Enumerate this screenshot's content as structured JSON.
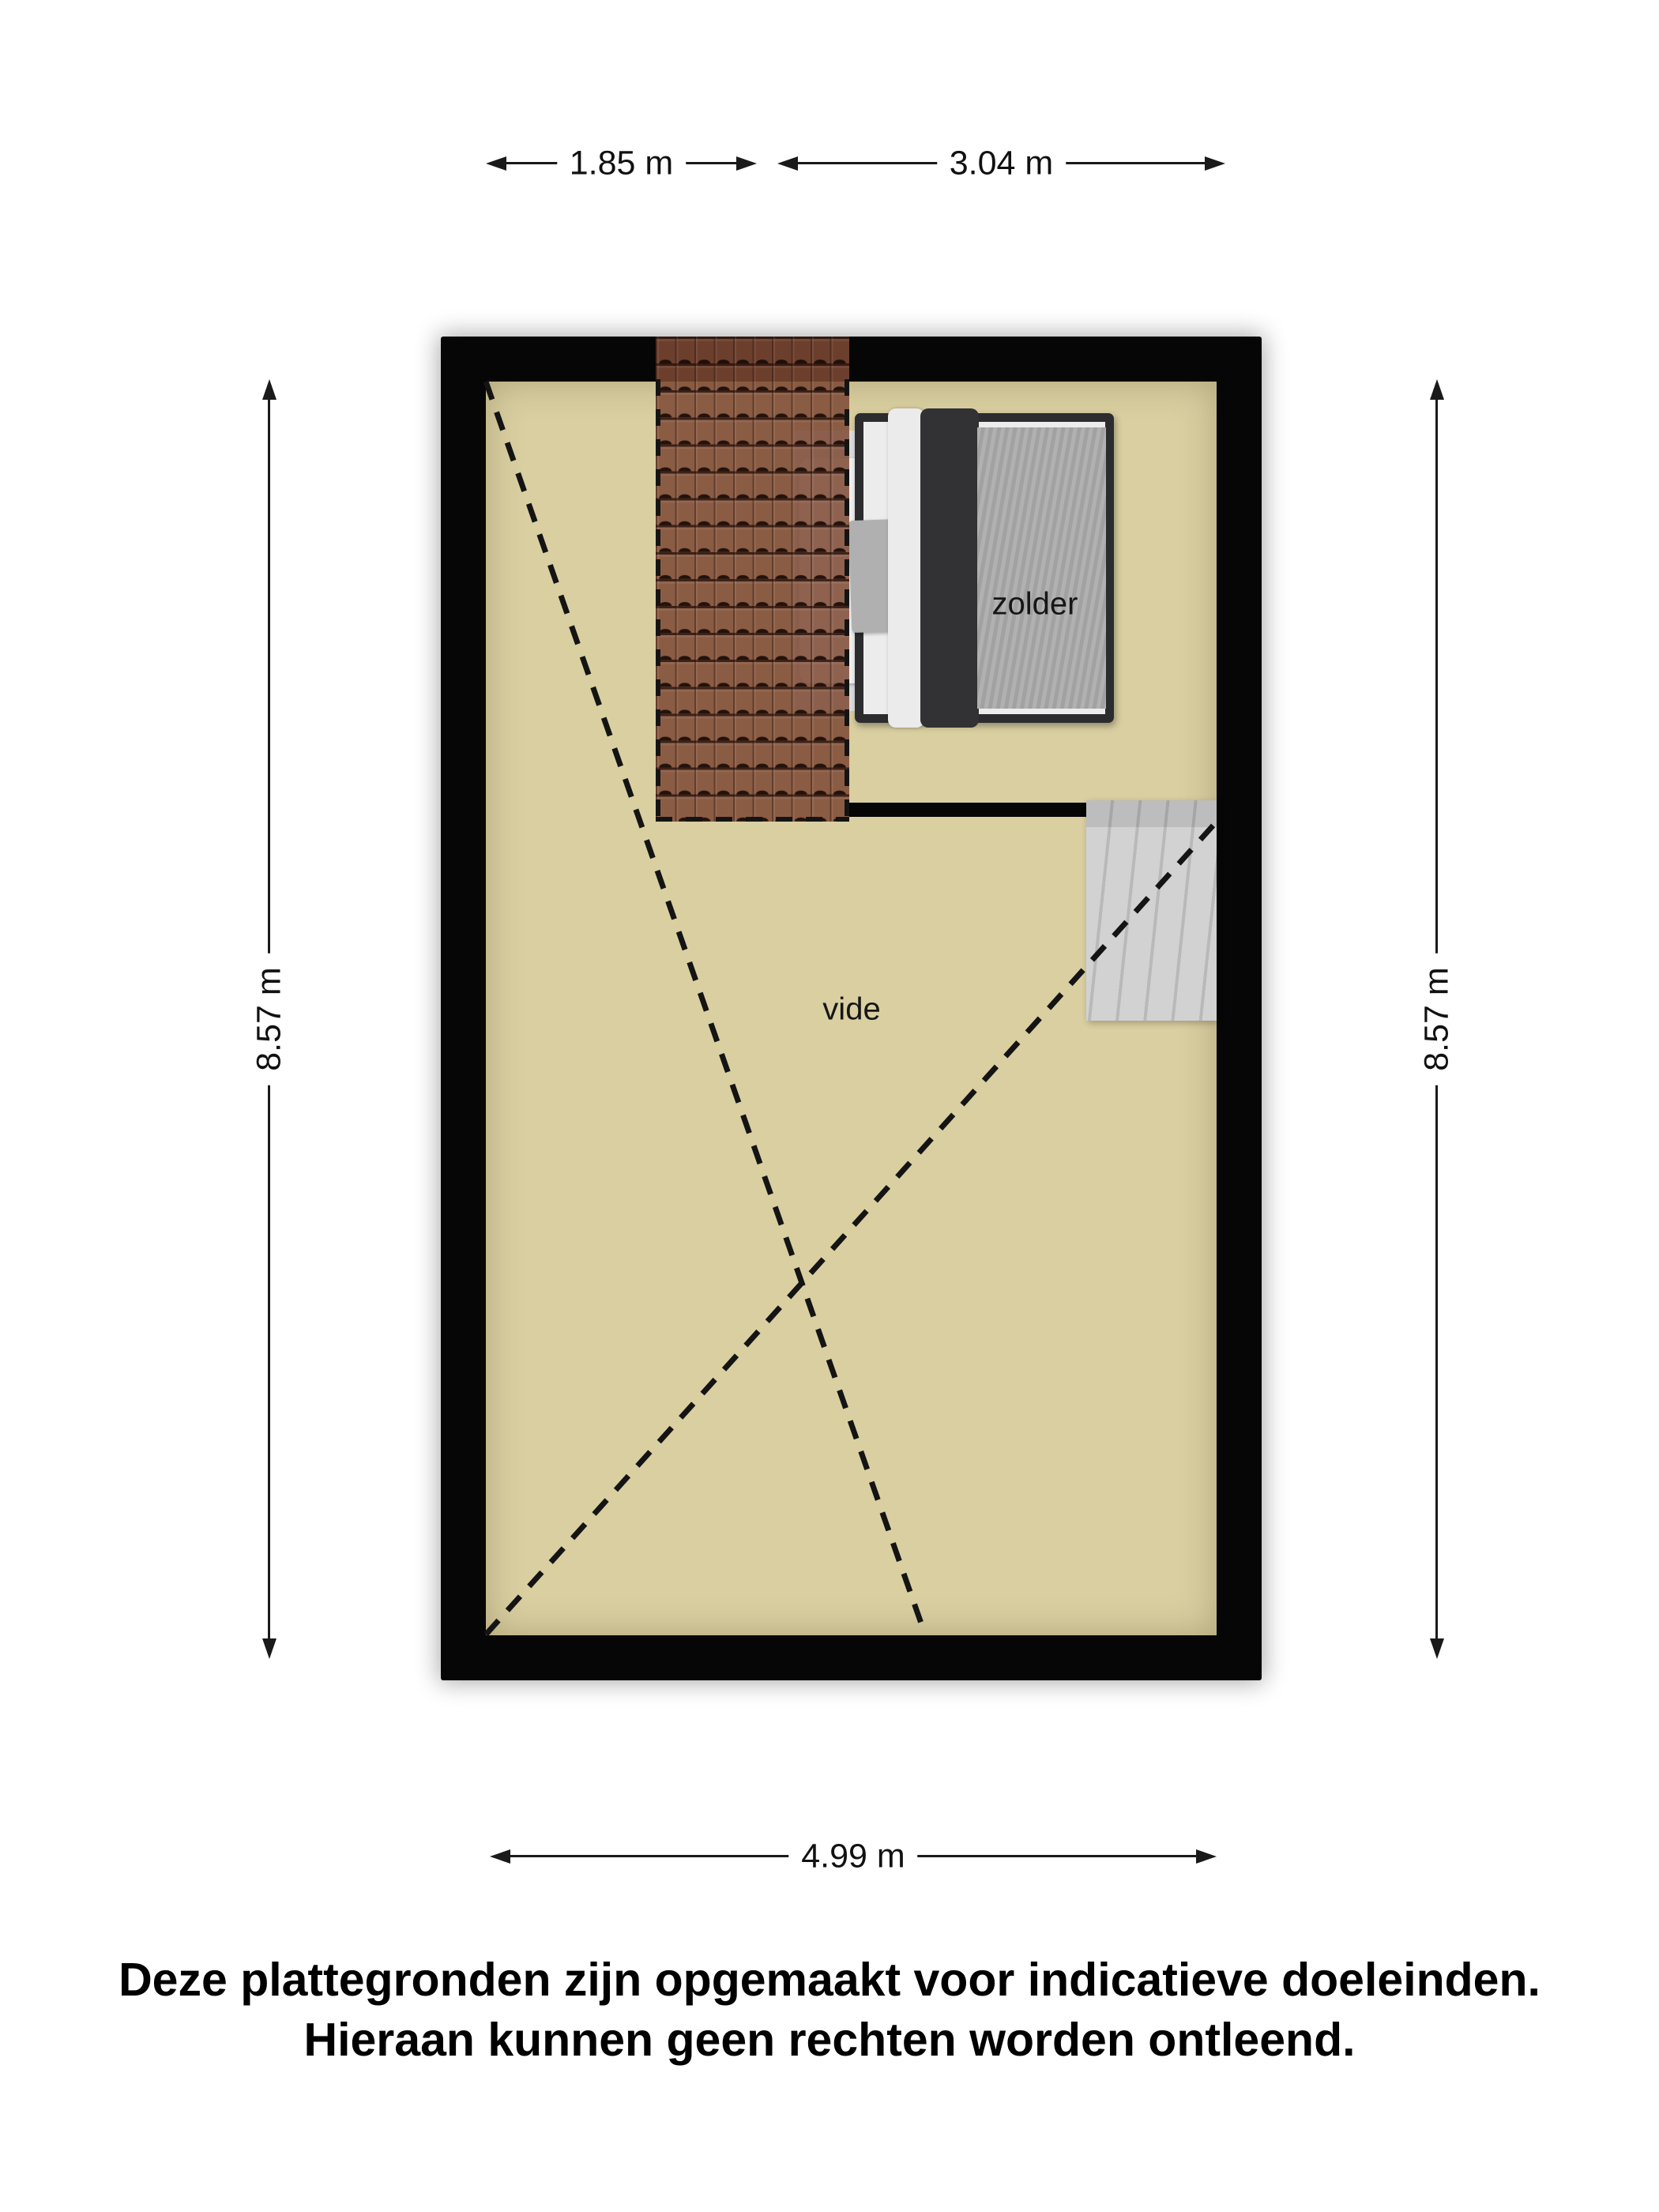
{
  "floorplan": {
    "room_labels": {
      "zolder": "zolder",
      "vide": "vide"
    },
    "dimensions": {
      "top_left": "1.85 m",
      "top_right": "3.04 m",
      "side_left": "8.57 m",
      "side_right": "8.57 m",
      "bottom": "4.99 m"
    },
    "colors": {
      "floor": "#d9cfa1",
      "wall": "#060606",
      "roof_tiles": "#7e4934",
      "stairs": "#c9c9c9",
      "bed_frame": "#2c2c2e",
      "bed_duvet": "#a8a8a8",
      "dimension_lines": "#1a1a1a"
    }
  },
  "disclaimer": {
    "line1": "Deze plattegronden zijn opgemaakt voor indicatieve doeleinden.",
    "line2": "Hieraan kunnen geen rechten worden ontleend."
  }
}
